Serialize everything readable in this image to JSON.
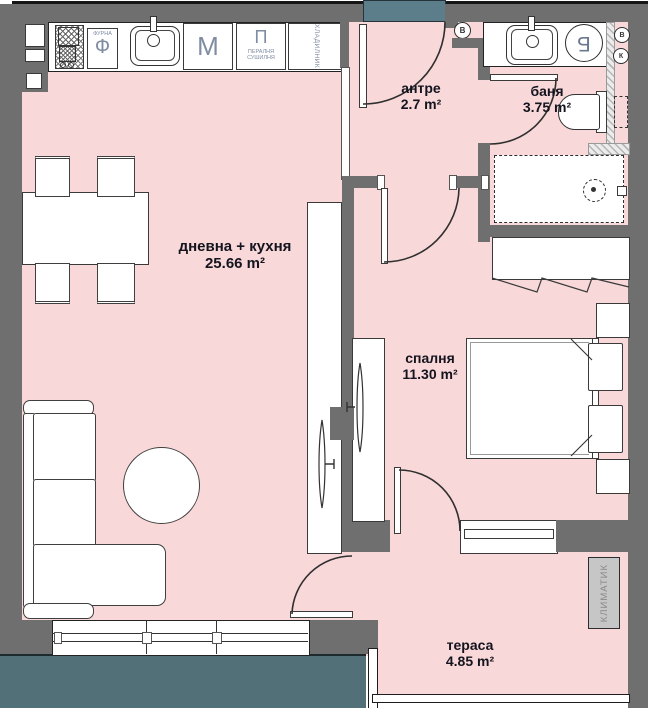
{
  "plan": {
    "rooms": {
      "entry": {
        "name": "антре",
        "area": "2.7 m²"
      },
      "bath": {
        "name": "баня",
        "area": "3.75 m²"
      },
      "living": {
        "name": "дневна + кухня",
        "area": "25.66 m²"
      },
      "bedroom": {
        "name": "спалня",
        "area": "11.30 m²"
      },
      "terrace": {
        "name": "тераса",
        "area": "4.85 m²"
      }
    },
    "kitchen": {
      "oven_label": "ФУРНА",
      "oven_letter": "Ф",
      "dishwasher_letter": "М",
      "laundry_letter": "П",
      "laundry_line1": "ПЕРАЛНЯ",
      "laundry_line2": "СУШИЛНЯ",
      "fridge_label": "ХЛАДИЛНИК"
    },
    "bathroom": {
      "boiler_letter": "Б"
    },
    "shafts": {
      "entry_shaft": "В",
      "vent_shaft": "В",
      "sewer_shaft": "К"
    },
    "terrace_unit": {
      "ac_label": "КЛИМАТИК"
    },
    "colors": {
      "wall": "#6f6f6f",
      "floor": "#f8d8d8",
      "exterior_top": "#5c7d8a",
      "exterior_bottom": "#527078",
      "appliance_text": "#7f8ca2",
      "label_text": "#14141e",
      "ac_fill": "#c6c6c6",
      "ac_text": "#8a8a8a"
    }
  }
}
